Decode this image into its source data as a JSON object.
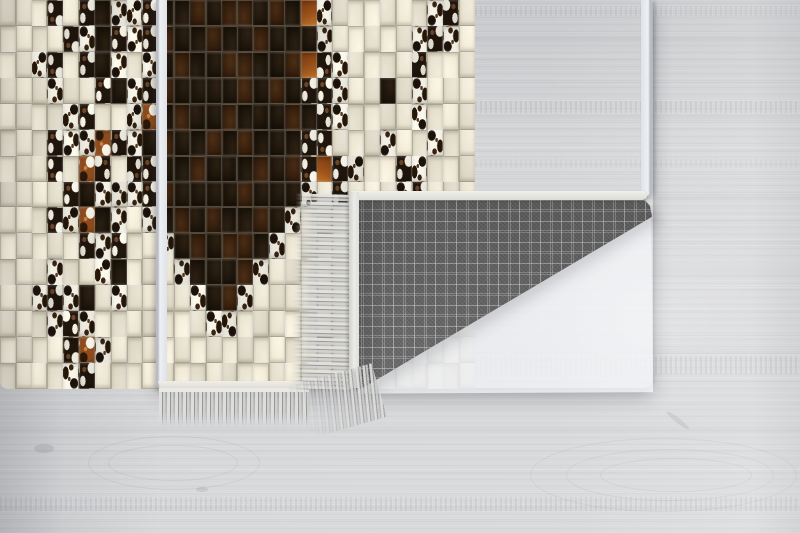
{
  "scene": {
    "type": "product-photo",
    "subject": "patchwork cowhide mosaic rug with folded corner showing woven backing",
    "floor": {
      "base_color": "#d3d4d6",
      "shade_left": "#c6c8cb",
      "bright_right": "#e5e6e9",
      "plank_seam_color": "#9fa1a6"
    },
    "rug": {
      "cols": 30,
      "rows": 15,
      "binding_color": "#eef0f3",
      "seam_color": "#aca593",
      "tile_palette": {
        "C": "#e9e3d0",
        "K": "#181108",
        "D": "#2a1809",
        "W": "#f1eee3",
        "X": "#20150c",
        "O": "#a2551b",
        "B": "#8a4a1c"
      },
      "tile_legend": {
        "C": "cream marble",
        "K": "black hide",
        "D": "dark brown hide",
        "W": "white cowhide with dark spots",
        "X": "dark cowhide with white patches",
        "O": "rust orange hide",
        "B": "brown-and-white cowhide"
      },
      "pattern_rows": [
        "CCCXCXKWWXKKDKDDKDKOWCCCCCCWXC",
        "CCCCXWKXWXDKKDKKDKKKWCCCCCWXWC",
        "CCWXCXKWCWKDKKDDKKDOXWCCCCXCCC",
        "CCCWCCXKWXDKKKKDKDKXXWCCKCWCCC",
        "CCCCWXCCWBKDKKDKKKDKXWCCCCWCCC",
        "CCCXWWBXWKDKKDKDKKKXXCCCWCCWCC",
        "CCCXCBXCXXKKDKKKDKDXOXWCCXWCCC",
        "CCCCXKWWWXDKKKKDKKKWCXCCCWXCCC",
        "CCCXWBKWCWKDKDKKDKWCCCCCCCCCCC",
        "CCCCCXWXCCWKDKDDKWCCCCCCCCCCCC",
        "CCCWCCWKCCCWKKKDWCCCCCCCCCCCCC",
        "CCWXWKCWCCCCWKDWCCCCCCCCCCCCCC",
        "CCCWXWCCCCCCCWWCCCCCCCCCCCCCCC",
        "CCCCXBWCCCCCCCCCCCCCCCCCCCCCCC",
        "CCCCWXCCCCCCCCCCCCCCCCCCCCCCCC"
      ]
    },
    "fringe": {
      "color": "#dcdbd8",
      "gap_color": "#949492"
    },
    "backing": {
      "base_color": "#666666",
      "check_line_color": "#dcdcdc",
      "binding_color": "#e8e7e2",
      "pattern": "glen check plaid"
    }
  }
}
